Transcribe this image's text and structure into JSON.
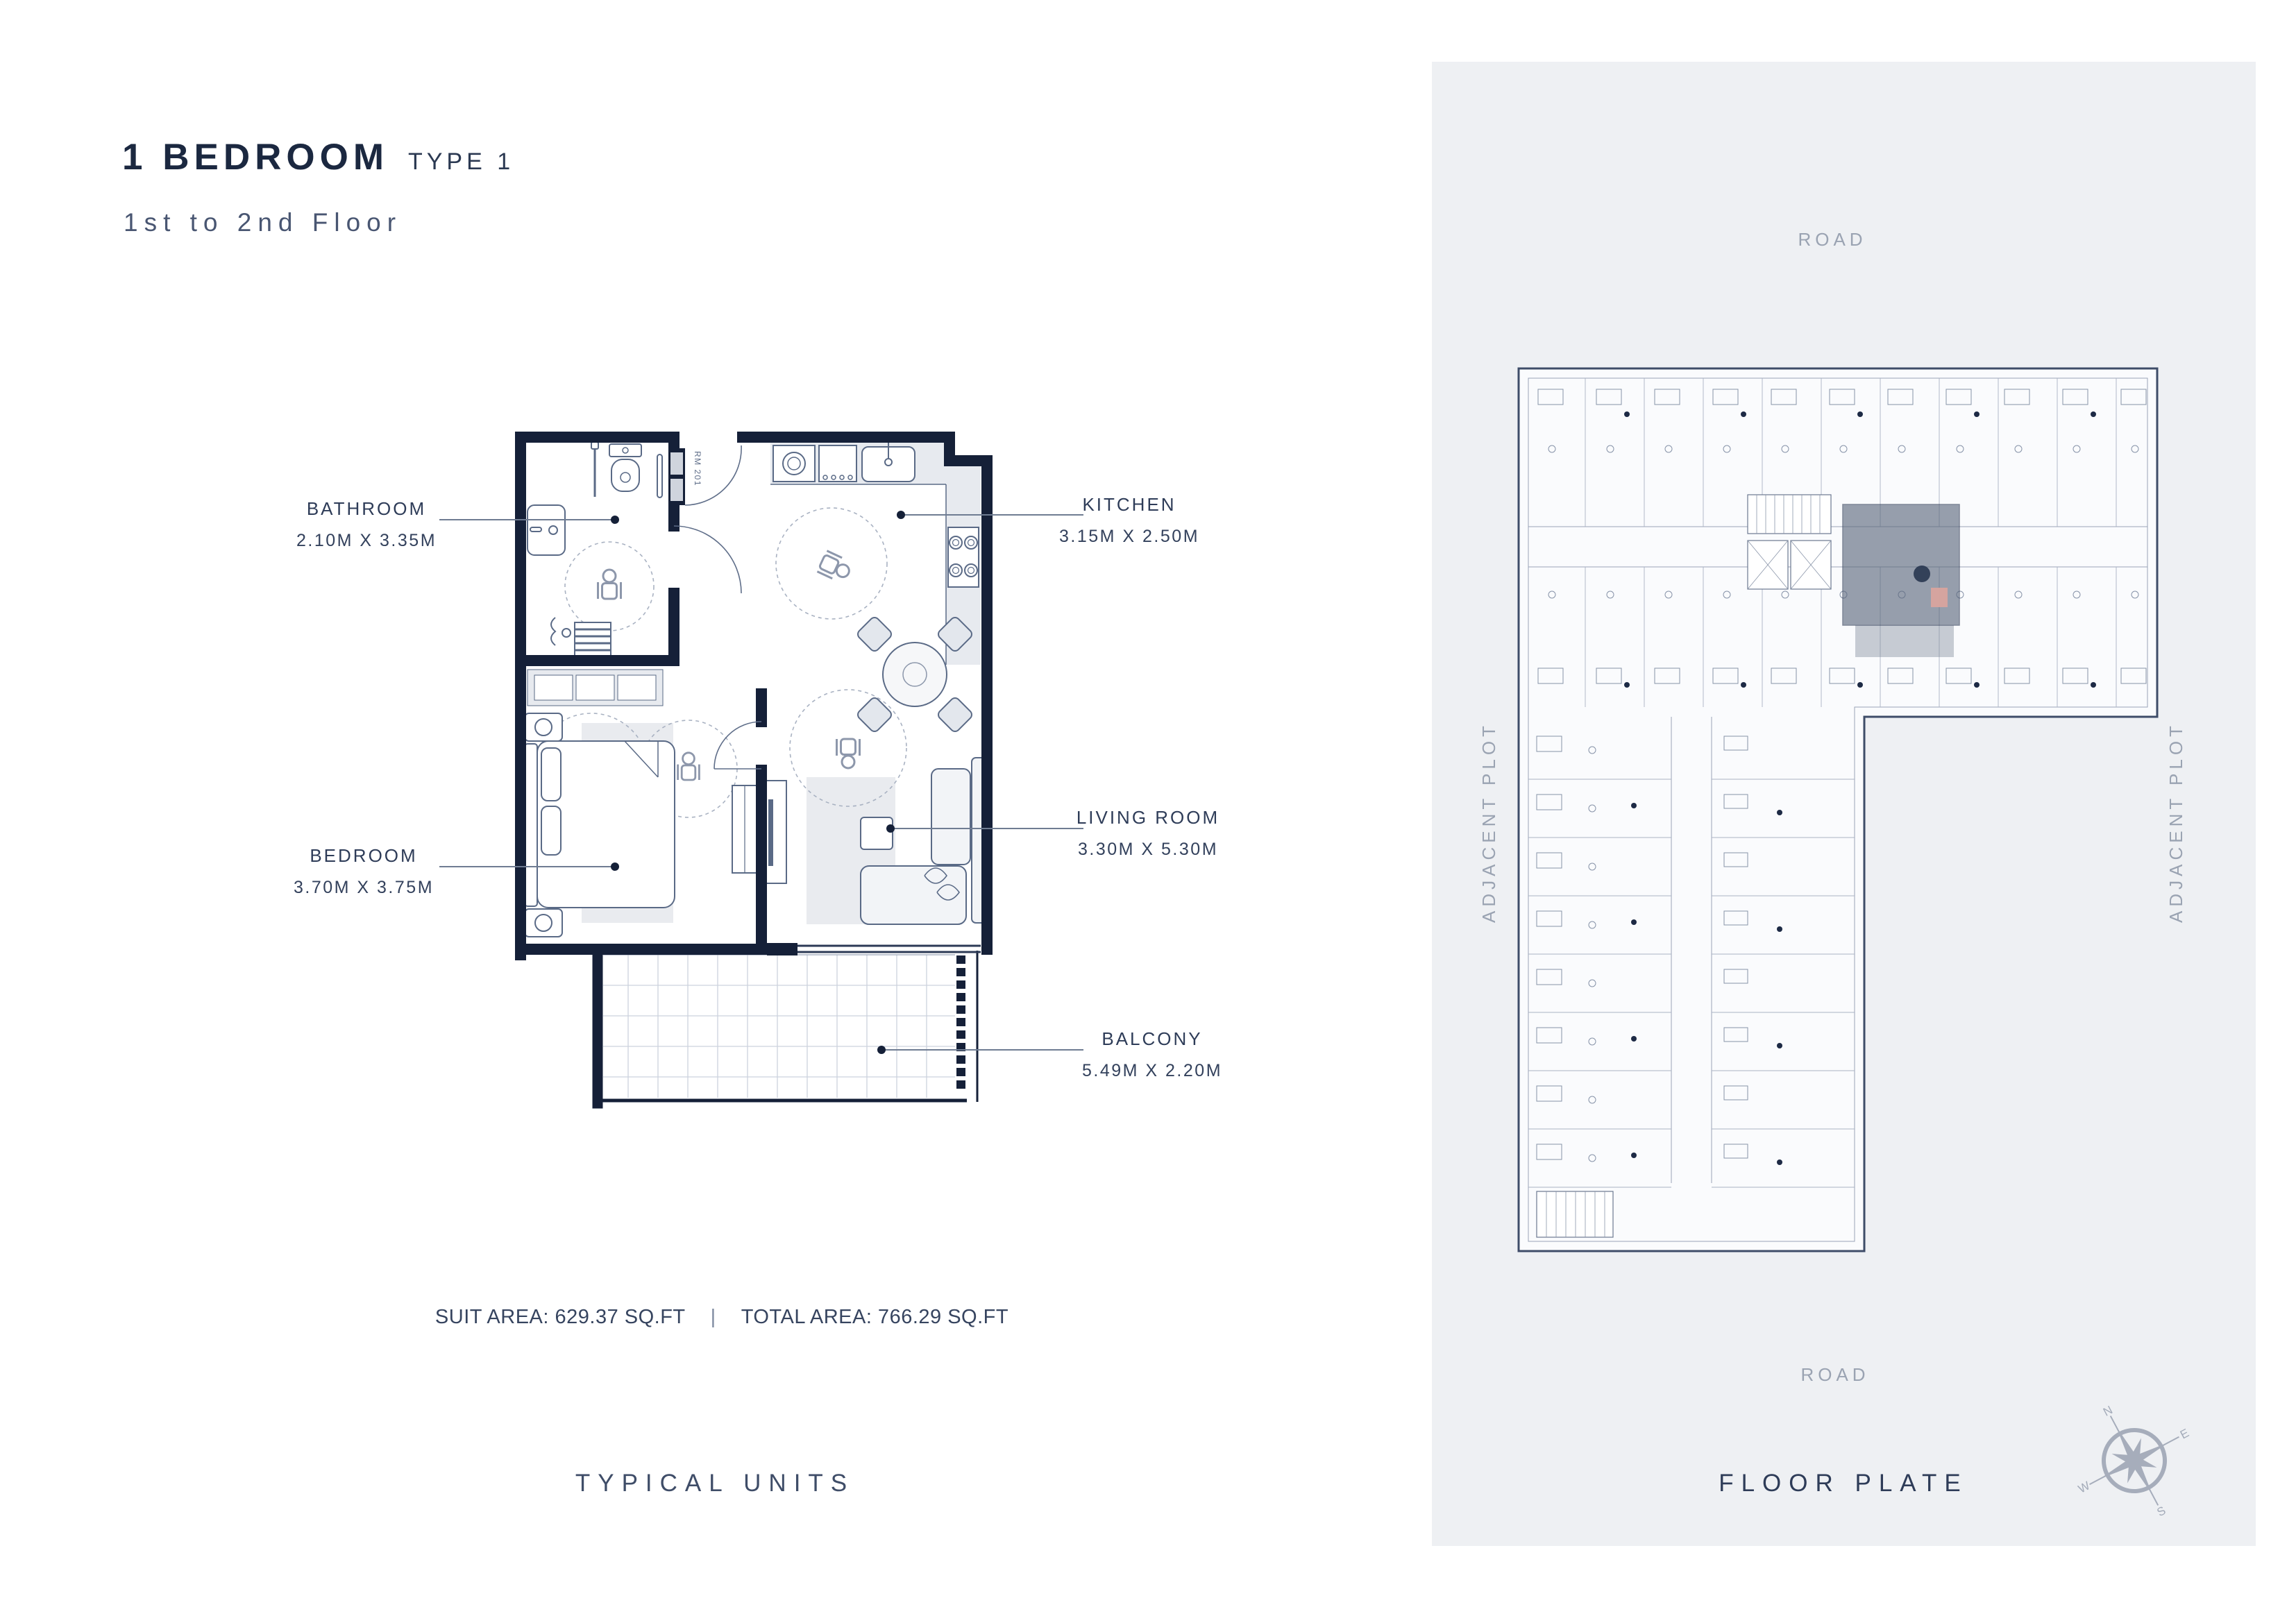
{
  "page": {
    "title_bold": "1 BEDROOM",
    "title_light": "TYPE 1",
    "subtitle": "1st to 2nd Floor"
  },
  "unit_plan": {
    "rooms": [
      {
        "id": "bathroom",
        "label": "BATHROOM",
        "dimensions": "2.10M X 3.35M"
      },
      {
        "id": "kitchen",
        "label": "KITCHEN",
        "dimensions": "3.15M X 2.50M"
      },
      {
        "id": "bedroom",
        "label": "BEDROOM",
        "dimensions": "3.70M X 3.75M"
      },
      {
        "id": "living_room",
        "label": "LIVING ROOM",
        "dimensions": "3.30M X 5.30M"
      },
      {
        "id": "balcony",
        "label": "BALCONY",
        "dimensions": "5.49M X 2.20M"
      }
    ],
    "room_number": "RM 201",
    "areas": {
      "suit": "SUIT AREA: 629.37 SQ.FT",
      "separator": "|",
      "total": "TOTAL AREA: 766.29 SQ.FT"
    },
    "caption": "TYPICAL UNITS"
  },
  "floor_plate": {
    "caption": "FLOOR PLATE",
    "road_top": "ROAD",
    "road_bottom": "ROAD",
    "adjacent_left": "ADJACENT PLOT",
    "adjacent_right": "ADJACENT PLOT",
    "compass": {
      "n": "N",
      "e": "E",
      "s": "S",
      "w": "W"
    }
  },
  "colors": {
    "wall_navy": "#152038",
    "label_text": "#2e3c58",
    "muted_gray": "#9aa3b2",
    "panel_bg": "#eef0f3",
    "unit_highlight": "#5a667c",
    "accent_salmon": "#d8a49e",
    "light_fill": "#e9ebef"
  }
}
